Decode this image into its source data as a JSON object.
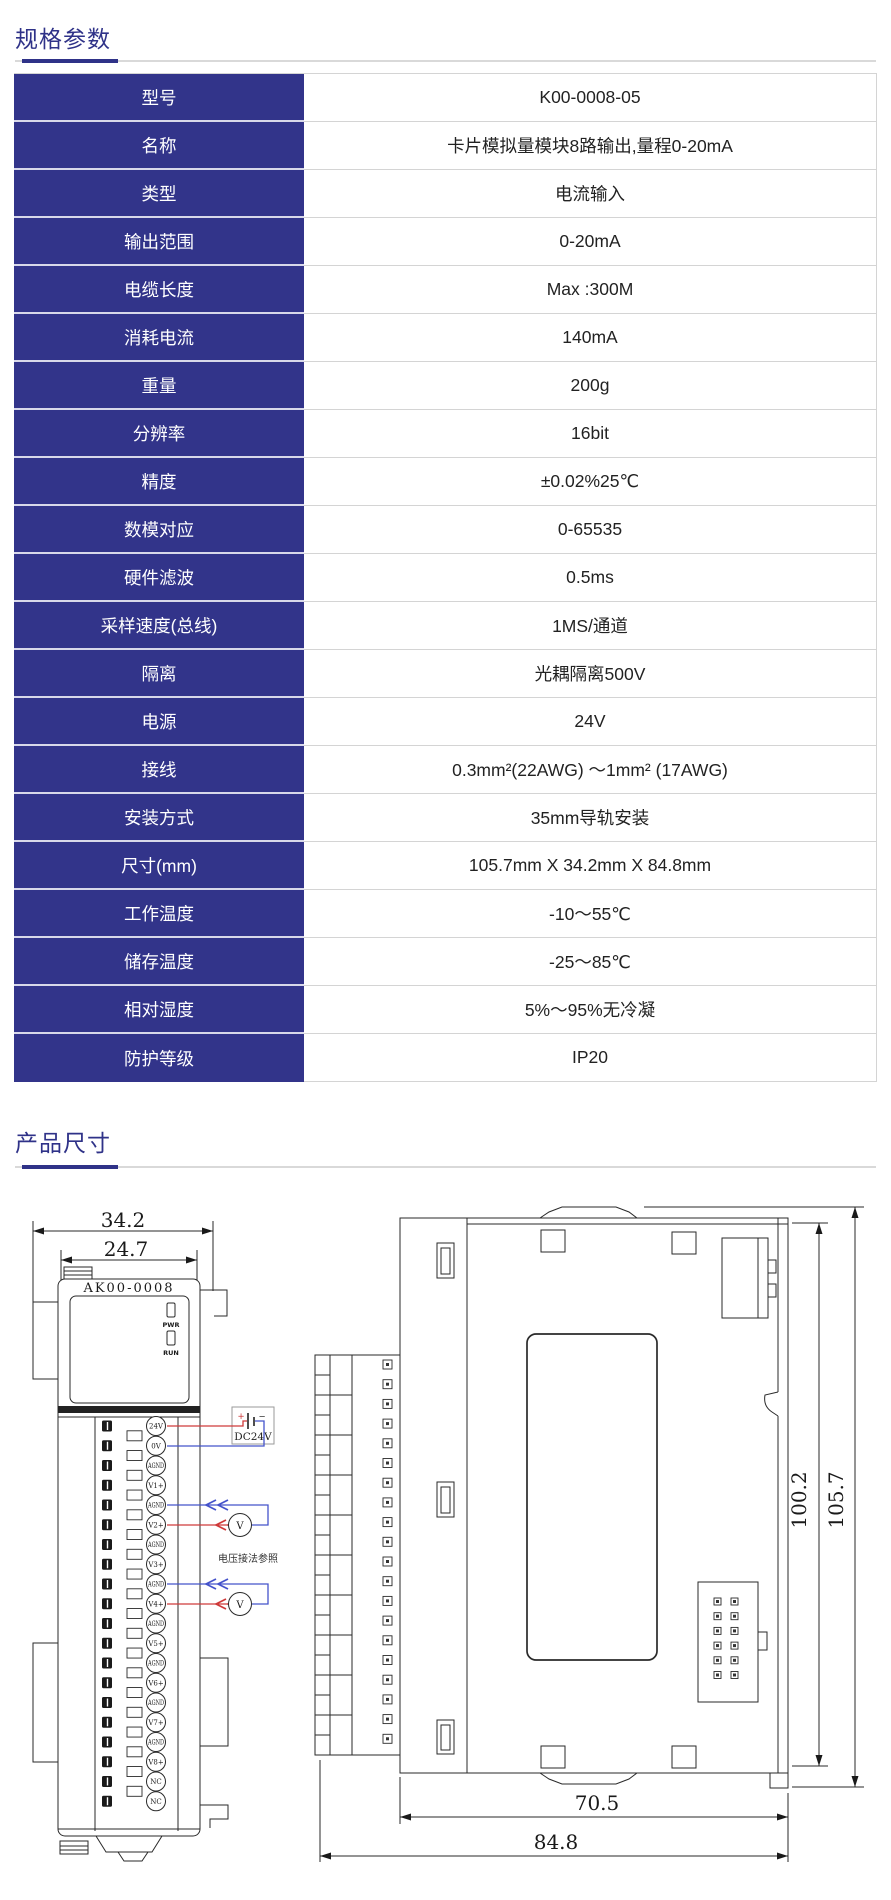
{
  "section_specs": {
    "title": "规格参数"
  },
  "spec_table": {
    "rows": [
      {
        "label": "型号",
        "value": "K00-0008-05"
      },
      {
        "label": "名称",
        "value": "卡片模拟量模块8路输出,量程0-20mA"
      },
      {
        "label": "类型",
        "value": "电流输入"
      },
      {
        "label": "输出范围",
        "value": "0-20mA"
      },
      {
        "label": "电缆长度",
        "value": "Max :300M"
      },
      {
        "label": "消耗电流",
        "value": "140mA"
      },
      {
        "label": "重量",
        "value": "200g"
      },
      {
        "label": "分辨率",
        "value": "16bit"
      },
      {
        "label": "精度",
        "value": "±0.02%25℃"
      },
      {
        "label": "数模对应",
        "value": "0-65535"
      },
      {
        "label": "硬件滤波",
        "value": "0.5ms"
      },
      {
        "label": "采样速度(总线)",
        "value": "1MS/通道"
      },
      {
        "label": "隔离",
        "value": "光耦隔离500V"
      },
      {
        "label": "电源",
        "value": "24V"
      },
      {
        "label": "接线",
        "value": "0.3mm²(22AWG) ～1mm² (17AWG)"
      },
      {
        "label": "安装方式",
        "value": "35mm导轨安装"
      },
      {
        "label": "尺寸(mm)",
        "value": "105.7mm X 34.2mm X 84.8mm"
      },
      {
        "label": "工作温度",
        "value": "-10～55℃"
      },
      {
        "label": "储存温度",
        "value": "-25～85℃"
      },
      {
        "label": "相对湿度",
        "value": "5%～95%无冷凝"
      },
      {
        "label": "防护等级",
        "value": "IP20"
      }
    ]
  },
  "section_dims": {
    "title": "产品尺寸"
  },
  "front_view": {
    "dim_outer": "34.2",
    "dim_inner": "24.7",
    "model": "AK00-0008",
    "led_pwr": "PWR",
    "led_run": "RUN",
    "terminals": [
      "24V",
      "0V",
      "AGND",
      "V1+",
      "AGND",
      "V2+",
      "AGND",
      "V3+",
      "AGND",
      "V4+",
      "AGND",
      "V5+",
      "AGND",
      "V6+",
      "AGND",
      "V7+",
      "AGND",
      "V8+",
      "NC",
      "NC"
    ],
    "power_box": "DC24V",
    "battery_plus": "+",
    "battery_minus": "−",
    "meter": "V",
    "wiring_note": "电压接法参照"
  },
  "side_view": {
    "height_inner": "100.2",
    "height_outer": "105.7",
    "depth_inner": "70.5",
    "depth_outer": "84.8"
  },
  "colors": {
    "accent": "#2f3288",
    "table_header_bg": "#32348a",
    "wire_red": "#cf3a3a",
    "wire_blue": "#4553cb"
  }
}
